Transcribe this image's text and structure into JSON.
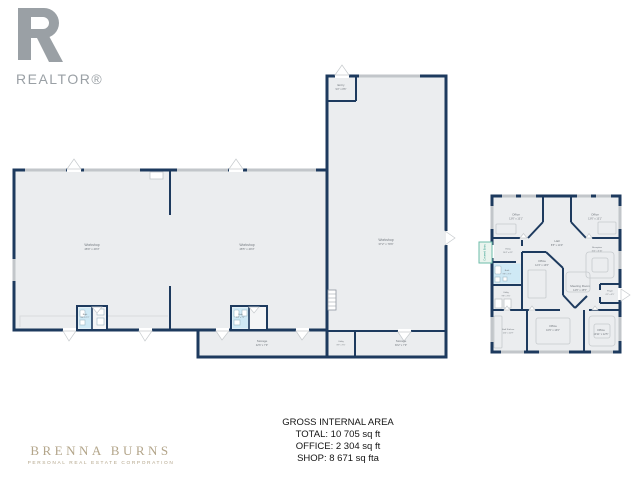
{
  "branding": {
    "realtor": {
      "word": "REALTOR®"
    },
    "agent": {
      "name": "BRENNA BURNS",
      "tagline": "PERSONAL REAL ESTATE CORPORATION"
    }
  },
  "summary": {
    "title": "GROSS INTERNAL AREA",
    "total": "TOTAL: 10 705 sq ft",
    "office": "OFFICE: 2 304 sq ft",
    "shop": "SHOP: 8 671 sq fta"
  },
  "colors": {
    "wall": "#1d3a5e",
    "room_fill": "#ebedef",
    "bath_fill": "#cfe9f5",
    "window": "#c2c6ca",
    "accent_teal": "#2f9c8a",
    "brand_gold": "#b3a58a",
    "logo_gray": "#9aa0a5"
  },
  "shop_plan": {
    "rooms": {
      "workshop_left": {
        "name": "Workshop",
        "dims": "48'9\" x 49'3\""
      },
      "workshop_mid": {
        "name": "Workshop",
        "dims": "48'5\" x 49'3\""
      },
      "workshop_tall": {
        "name": "Workshop",
        "dims": "37'2\" x 79'6\""
      },
      "entry": {
        "name": "Entry",
        "dims": "9'2\" x 8'6\""
      },
      "bath_left": {
        "name": "Bath",
        "dims": "4'6\" x 7'2\""
      },
      "bath_mid": {
        "name": "Bath",
        "dims": "5'2\" x 7'2\""
      },
      "storage_long": {
        "name": "Storage",
        "dims": "42'6\" x 7'9\""
      },
      "utility_small": {
        "name": "Utility",
        "dims": "8'9\" x 7'6\""
      },
      "storage_right": {
        "name": "Storage",
        "dims": "30'2\" x 7'9\""
      }
    }
  },
  "office_plan": {
    "porch_label": "Covered Entry",
    "rooms": {
      "office_tl": {
        "name": "Office",
        "dims": "13'6\" x 13'1\""
      },
      "office_tr": {
        "name": "Office",
        "dims": "13'6\" x 13'1\""
      },
      "hall": {
        "name": "Hall",
        "dims": "8'5\" x 14'0\""
      },
      "entry": {
        "name": "Entry",
        "dims": "16'4\" x 6'5\""
      },
      "reception": {
        "name": "Reception",
        "dims": "15'4\" x 6'10\""
      },
      "bath": {
        "name": "Bath",
        "dims": "9'8\" x 7'3\""
      },
      "office_mid": {
        "name": "Office",
        "dims": "12'4\" x 13'6\""
      },
      "utility": {
        "name": "Utility",
        "dims": "9'8\" x 7'6\""
      },
      "meeting": {
        "name": "Meeting Room",
        "dims": "14'6\" x 15'5\""
      },
      "foyer": {
        "name": "Foyer",
        "dims": "6'5\" x 5'5\""
      },
      "staff_kitchen": {
        "name": "Staff Kitchen",
        "dims": "11'5\" x 12'9\""
      },
      "office_bm": {
        "name": "Office",
        "dims": "16'9\" x 13'0\""
      },
      "office_br": {
        "name": "Office",
        "dims": "10'11\" x 12'5\""
      }
    }
  }
}
